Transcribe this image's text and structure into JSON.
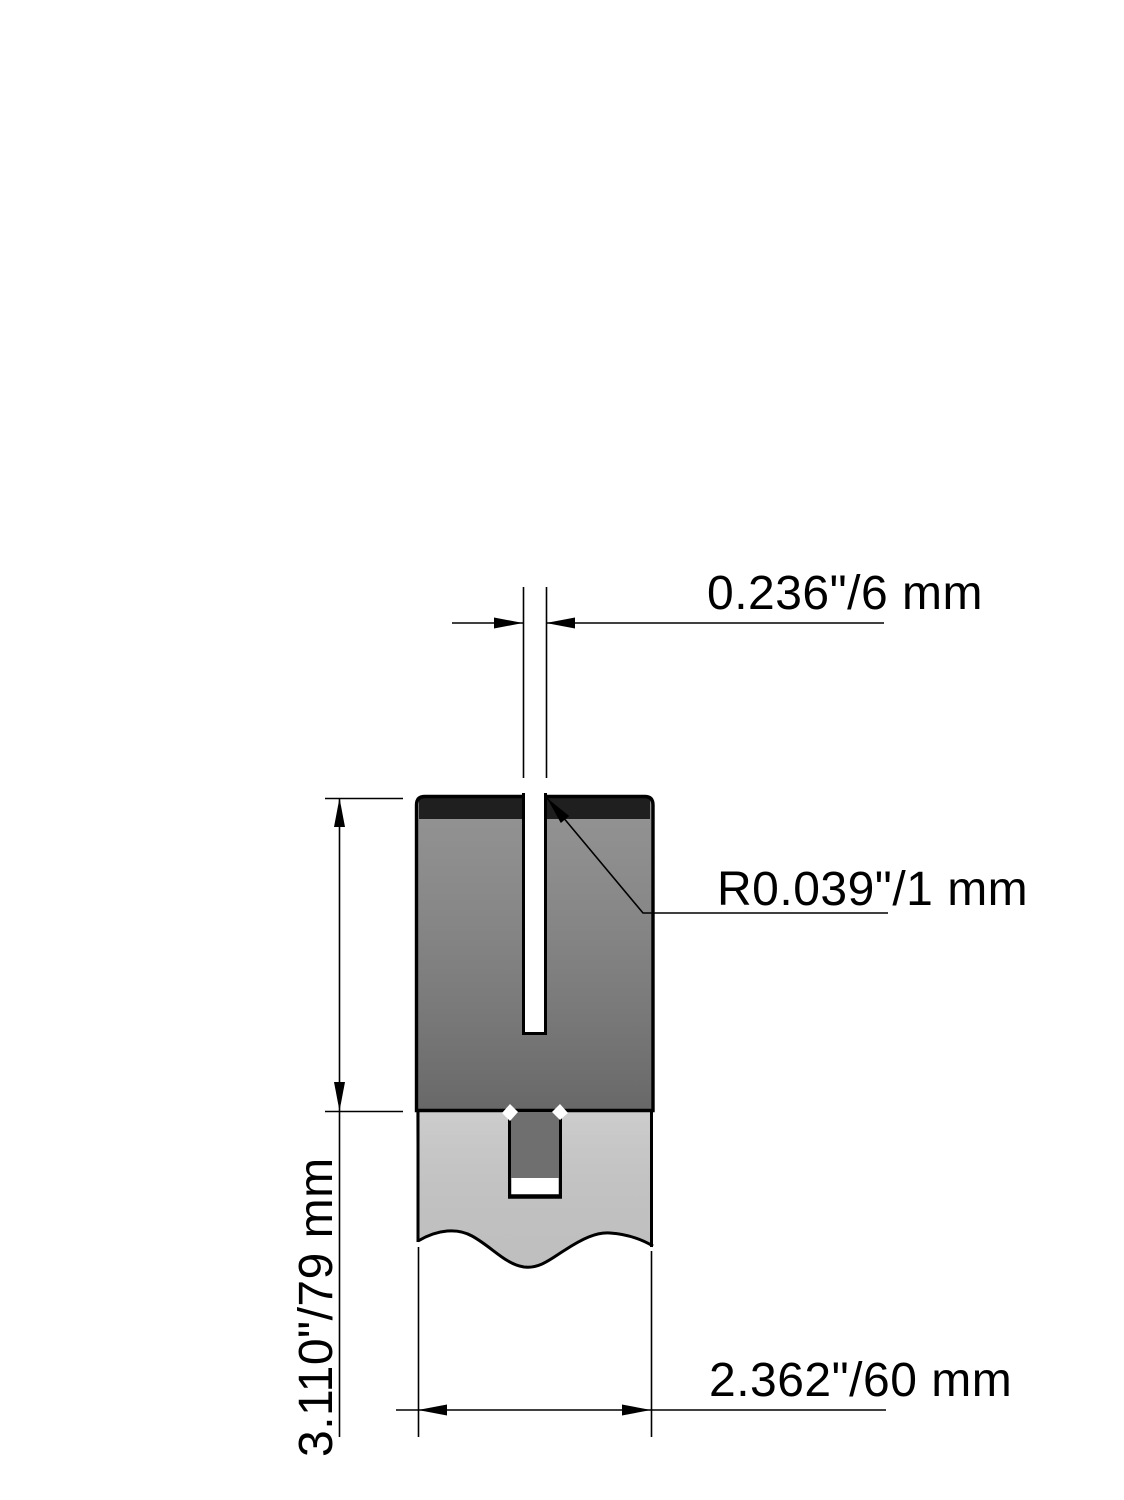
{
  "drawing": {
    "type": "technical-dimension-drawing",
    "view": "press-brake-die-cross-section",
    "labels": {
      "slot_width": "0.236\"/6 mm",
      "slot_corner_radius": "R0.039\"/1 mm",
      "die_height": "3.110\"/79 mm",
      "die_width": "2.362\"/60 mm"
    },
    "colors": {
      "background": "#ffffff",
      "outline": "#000000",
      "dimension_lines": "#000000",
      "die_fill": "#828282",
      "hardened_edge_band": "#1f1f1f",
      "tang_fill": "#6f6f6f",
      "holder_fill": "#c7c7c7",
      "slot_fill": "#ffffff"
    }
  }
}
